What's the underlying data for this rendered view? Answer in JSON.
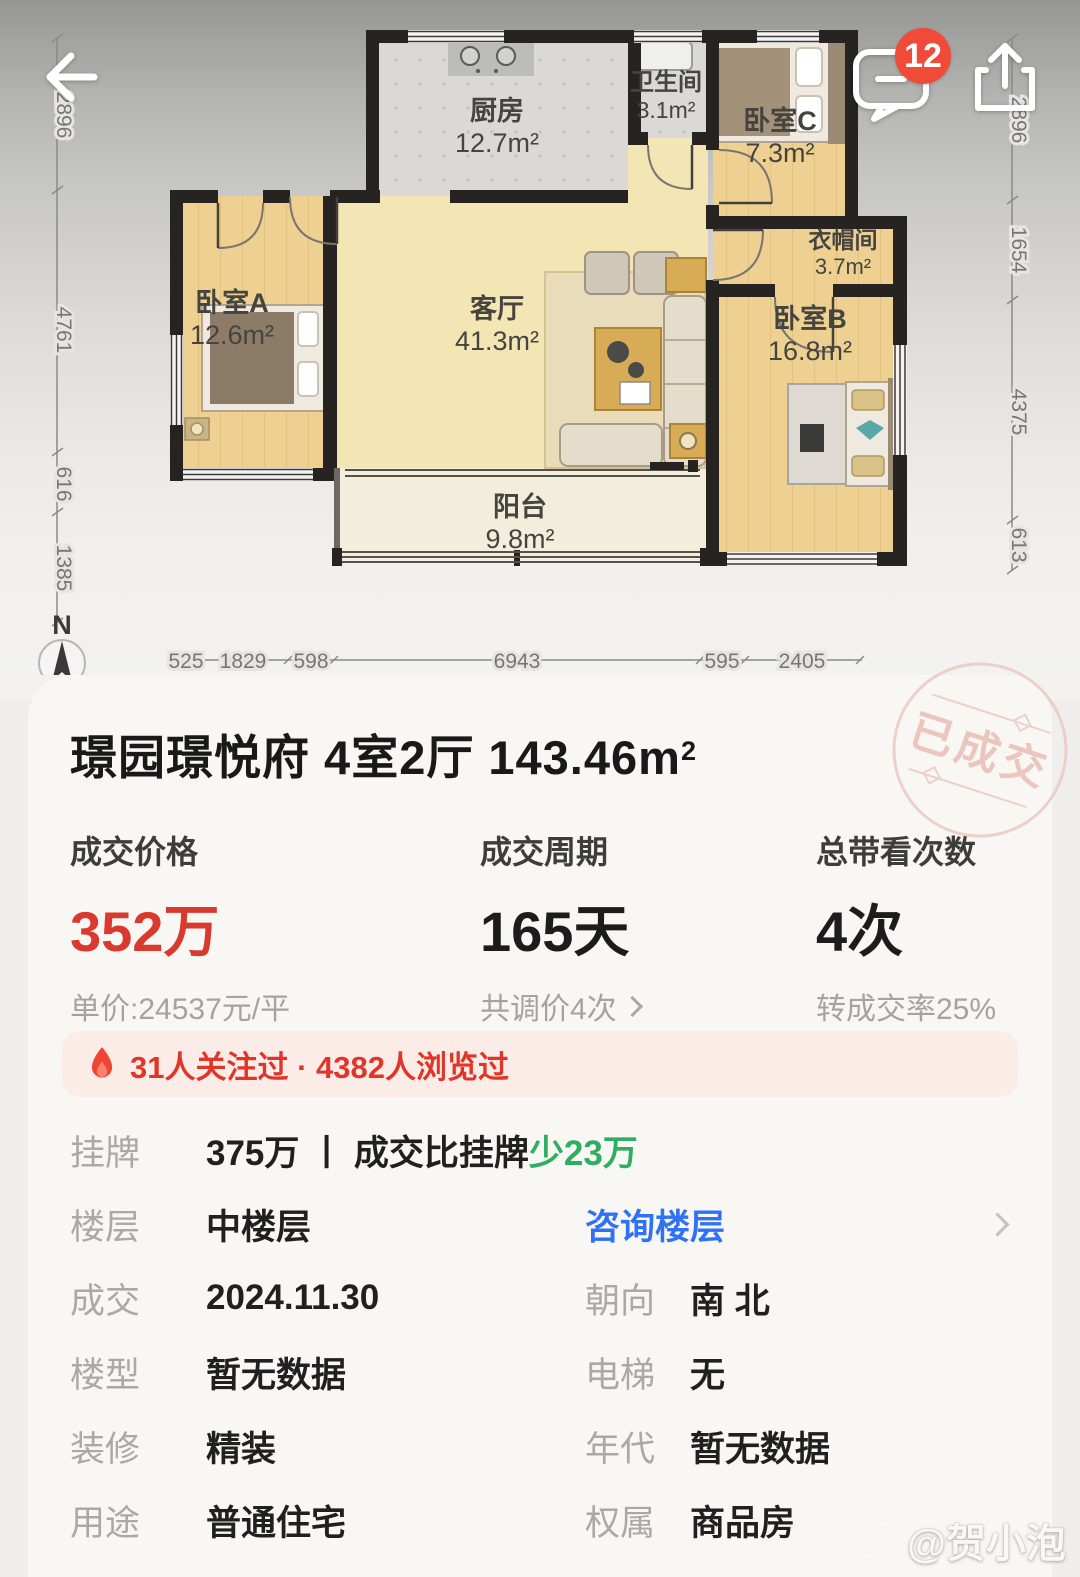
{
  "header": {
    "badge_count": "12"
  },
  "floorplan": {
    "compass": "N",
    "rooms": {
      "kitchen": {
        "name": "厨房",
        "area": "12.7m²"
      },
      "bath": {
        "name": "卫生间",
        "area": "3.1m²"
      },
      "bedC": {
        "name": "卧室C",
        "area": "7.3m²"
      },
      "closet": {
        "name": "衣帽间",
        "area": "3.7m²"
      },
      "bedA": {
        "name": "卧室A",
        "area": "12.6m²"
      },
      "living": {
        "name": "客厅",
        "area": "41.3m²"
      },
      "bedB": {
        "name": "卧室B",
        "area": "16.8m²"
      },
      "balcony": {
        "name": "阳台",
        "area": "9.8m²"
      }
    },
    "dims": {
      "left": [
        "2896",
        "4761",
        "616",
        "1385"
      ],
      "right": [
        "2896",
        "1654",
        "4375",
        "613"
      ],
      "bottom": [
        "525",
        "1829",
        "598",
        "6943",
        "595",
        "2405"
      ]
    }
  },
  "stamp": "已成交",
  "title": {
    "main": "璟园璟悦府 4室2厅 143.46m",
    "sup": "2"
  },
  "stats": {
    "price": {
      "label": "成交价格",
      "value": "352万",
      "sub": "单价:24537元/平"
    },
    "cycle": {
      "label": "成交周期",
      "value": "165天",
      "sub": "共调价4次"
    },
    "views": {
      "label": "总带看次数",
      "value": "4次",
      "sub": "转成交率25%"
    }
  },
  "banner": {
    "text": "31人关注过 · 4382人浏览过"
  },
  "rows": {
    "listing": {
      "label": "挂牌",
      "text": "375万 丨 成交比挂牌",
      "highlight": "少23万"
    },
    "floor": {
      "label": "楼层",
      "value": "中楼层",
      "link": "咨询楼层"
    },
    "deal": {
      "label": "成交",
      "value": "2024.11.30",
      "right_label": "朝向",
      "right_value": "南 北"
    },
    "building": {
      "label": "楼型",
      "value": "暂无数据",
      "right_label": "电梯",
      "right_value": "无"
    },
    "decoration": {
      "label": "装修",
      "value": "精装",
      "right_label": "年代",
      "right_value": "暂无数据"
    },
    "usage": {
      "label": "用途",
      "value": "普通住宅",
      "right_label": "权属",
      "right_value": "商品房"
    }
  },
  "watermark": "@贺小泡",
  "colors": {
    "accent_red": "#d93a2d",
    "badge_red": "#f04a38",
    "green": "#2fae62",
    "blue": "#3072f6",
    "stamp_pink": "#ecc0b9"
  }
}
